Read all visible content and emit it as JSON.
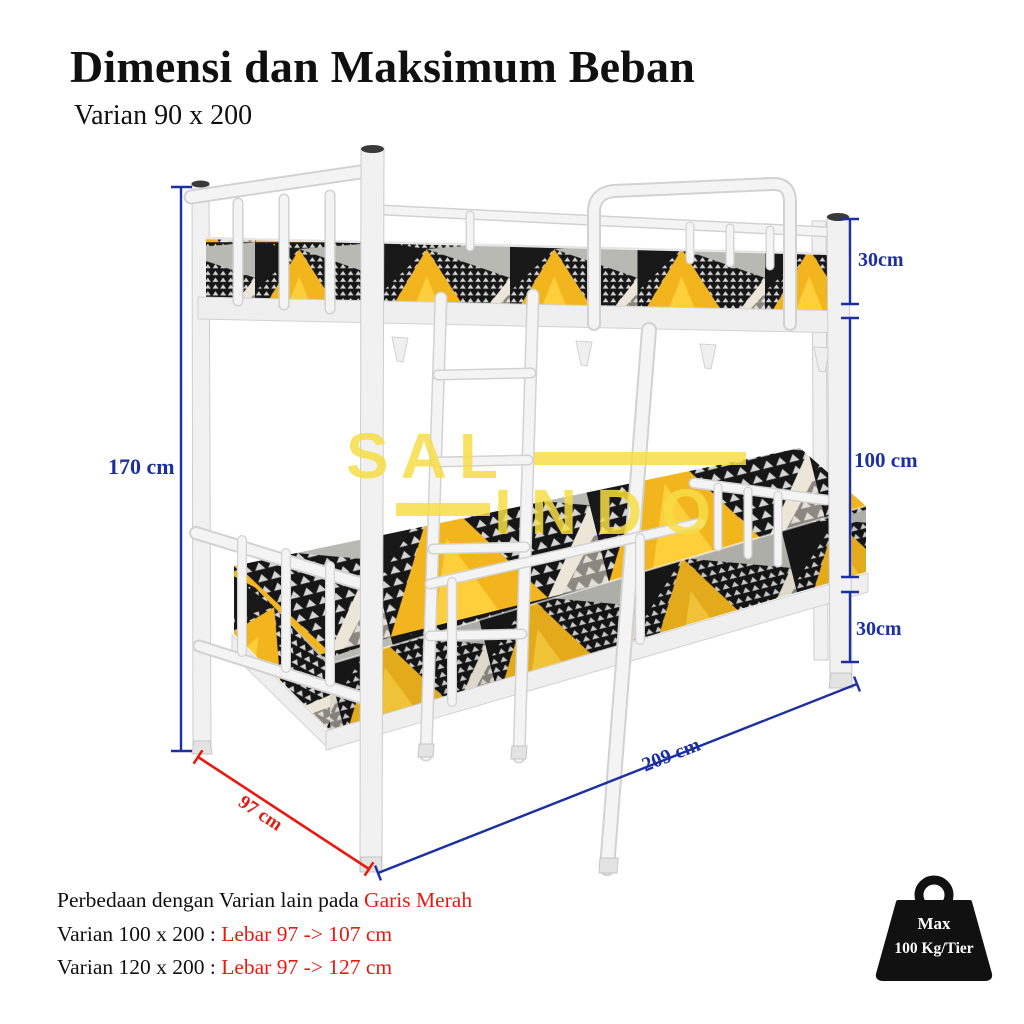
{
  "title": "Dimensi dan Maksimum Beban",
  "subtitle": "Varian 90 x 200",
  "dims": {
    "total_height": "170 cm",
    "top_tier_height": "30cm",
    "middle_clearance": "100 cm",
    "bottom_tier_height": "30cm",
    "length": "209 cm",
    "width": "97 cm"
  },
  "watermark": {
    "line1": "SAL",
    "line2": "INDO"
  },
  "notes": [
    {
      "black": "Perbedaan dengan Varian lain pada ",
      "red": "Garis Merah"
    },
    {
      "black": "Varian 100 x 200 : ",
      "red": "Lebar 97 -> 107 cm"
    },
    {
      "black": "Varian 120 x 200 : ",
      "red": "Lebar 97 -> 127 cm"
    }
  ],
  "badge": {
    "line1": "Max",
    "line2": "100 Kg/Tier"
  },
  "colors": {
    "dimension_blue": "#1c2fa3",
    "highlight_red": "#e81a10",
    "fabric_yellow": "#f2b51d",
    "fabric_black": "#161616",
    "watermark_yellow": "#f6dd46",
    "frame_white": "#f2f2f2"
  }
}
